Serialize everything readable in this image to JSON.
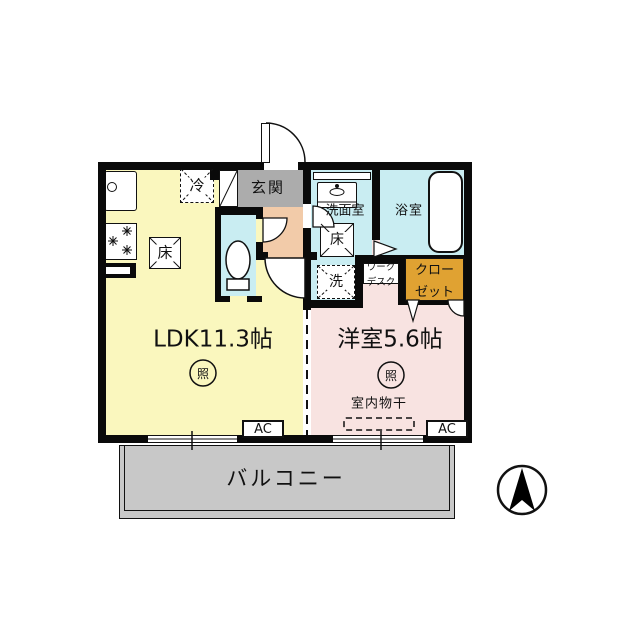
{
  "rooms": {
    "ldk": "LDK11.3帖",
    "western_room": "洋室5.6帖",
    "entrance": "玄関",
    "washroom": "洗面室",
    "bathroom": "浴室",
    "balcony": "バルコニー"
  },
  "labels": {
    "refrigerator": "冷",
    "floor": "床",
    "washer": "洗",
    "light": "照",
    "ac": "AC",
    "work_desk_line1": "ワーク",
    "work_desk_line2": "デスク",
    "closet_line1": "クロー",
    "closet_line2": "ゼット",
    "indoor_drying": "室内物干"
  },
  "colors": {
    "ldk_floor": "#FAF7BE",
    "western_floor": "#F8E3E1",
    "wet_area_floor": "#C9EDF2",
    "hall_floor": "#F2CBA9",
    "entrance_floor": "#ACACAC",
    "closet_fill": "#E0A232",
    "balcony_fill": "#C8C8C8",
    "wall": "#0A0A0A"
  }
}
